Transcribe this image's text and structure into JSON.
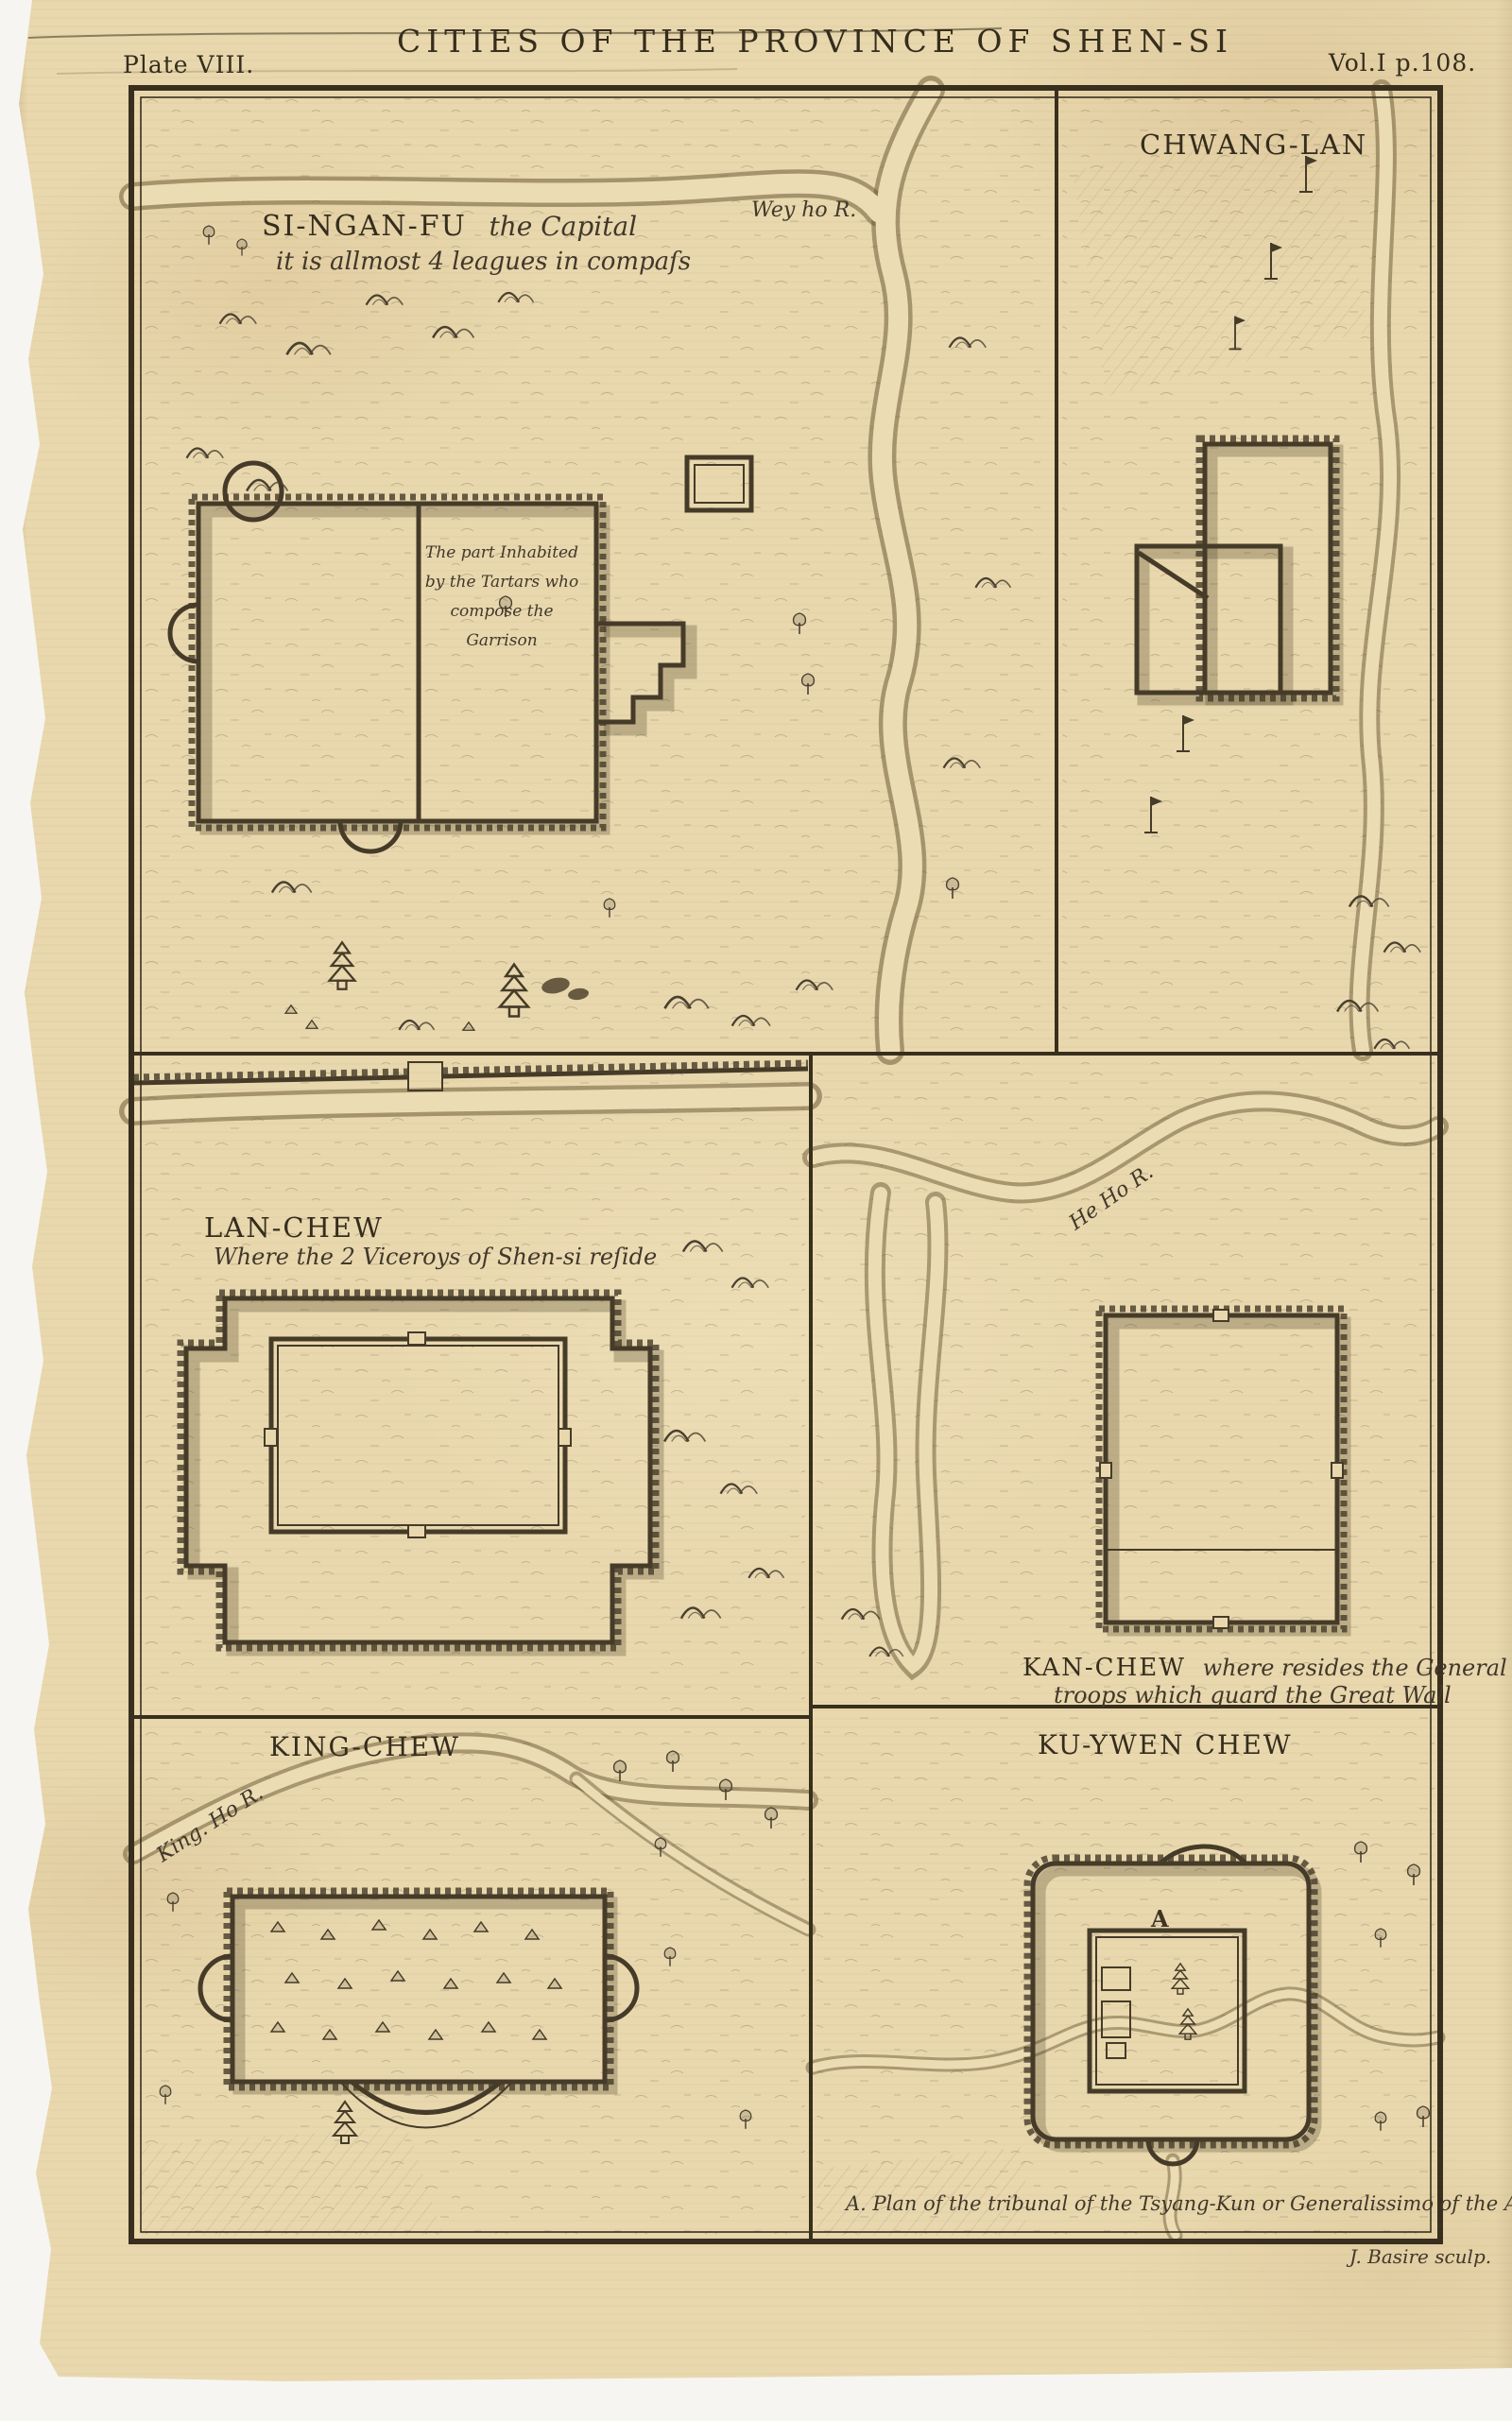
{
  "plate": {
    "number": "Plate VIII.",
    "title": "CITIES OF THE PROVINCE OF SHEN-SI",
    "volume": "Vol.I p.108.",
    "signature": "J. Basire sculp.",
    "colors": {
      "paper": "#e9d8ae",
      "ink": "#3e3526",
      "background": "#f6f5f1"
    }
  },
  "panels": {
    "si_ngan_fu": {
      "name": "SI-NGAN-FU",
      "name_suffix": "the Capital",
      "subtitle": "it is allmost 4 leagues in compaſs",
      "river_label": "Wey ho R.",
      "note_lines": [
        "The part Inhabited",
        "by the Tartars who",
        "compose the",
        "Garrison"
      ]
    },
    "chwang_lan": {
      "name": "CHWANG-LAN"
    },
    "lan_chew": {
      "name": "LAN-CHEW",
      "subtitle": "Where the 2 Viceroys of Shen-si reſide"
    },
    "kan_chew": {
      "name": "KAN-CHEW",
      "caption_line1": "where resides the General of the",
      "caption_line2": "troops which guard the Great Wall",
      "river_label": "He Ho R."
    },
    "king_chew": {
      "name": "KING-CHEW",
      "river_label": "King. Ho R."
    },
    "ku_ywen_chew": {
      "name": "KU-YWEN CHEW",
      "marker": "A",
      "caption": "A. Plan of the tribunal of the Tsyang-Kun or Generalissimo of the Army."
    }
  }
}
